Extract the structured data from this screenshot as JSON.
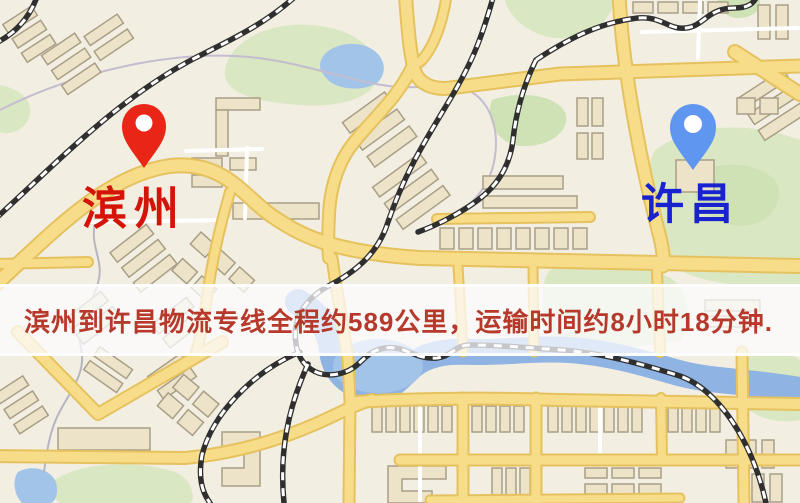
{
  "map": {
    "origin": {
      "label": "滨州",
      "pin_icon": "map-pin-icon",
      "pin_color": "#e92615",
      "label_color": "#d41408"
    },
    "destination": {
      "label": "许昌",
      "pin_icon": "map-pin-icon",
      "pin_color": "#5e96f0",
      "label_color": "#1822cf"
    },
    "banner": {
      "text": "滨州到许昌物流专线全程约589公里，运输时间约8小时18分钟.",
      "text_color": "#b7392b",
      "background_color": "rgba(252,252,255,0.74)"
    },
    "route": {
      "origin_city": "滨州",
      "destination_city": "许昌",
      "distance_text": "约589公里",
      "duration_text": "约8小时18分钟"
    }
  },
  "palette": {
    "map_base": "#f2eee2",
    "park_green": "#d9e7c2",
    "water_blue": "#a3c4e9",
    "river_blue": "#8fb3e3",
    "road_yellow": "#f7dc8a",
    "road_casing": "#e6c25e",
    "building_fill": "#ece3c9",
    "railway_dark": "#2f2f2f"
  }
}
